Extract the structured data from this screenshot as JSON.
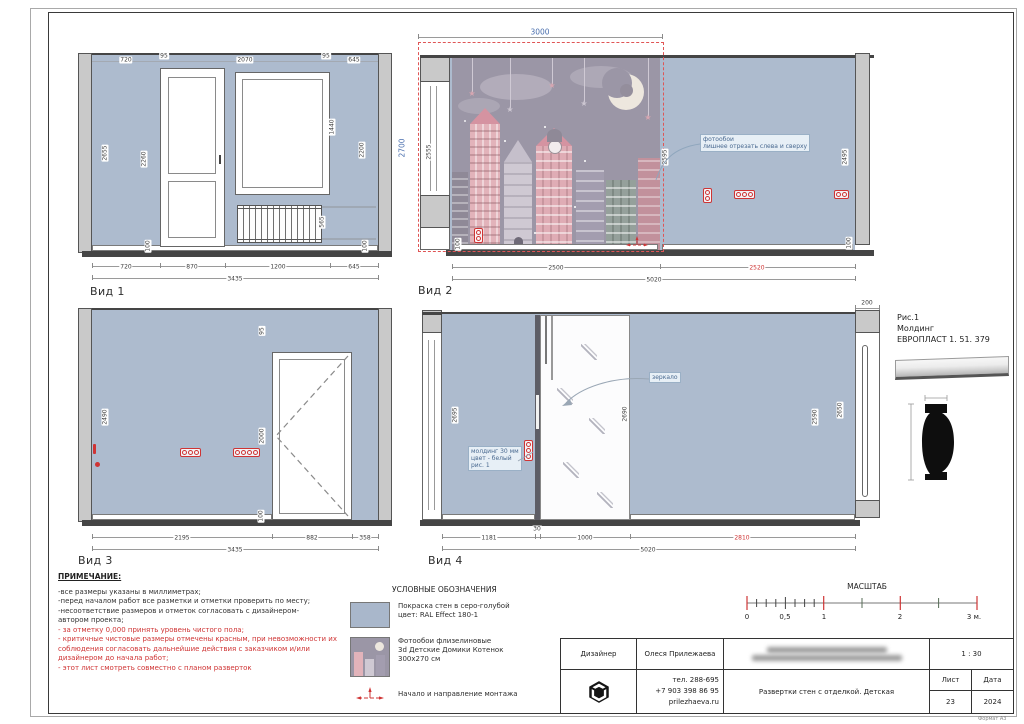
{
  "colors": {
    "wall_blue": "#adbbce",
    "critical_red": "#cf3434",
    "dim_blue": "#4a6fae"
  },
  "v1": {
    "label": "Вид 1",
    "top": [
      "720",
      "95",
      "2070",
      "95",
      "645"
    ],
    "bottom": [
      "720",
      "870",
      "1200",
      "645"
    ],
    "total": "3435",
    "left_h": "2655",
    "door_h": "2260",
    "window_h": "1440",
    "right_h": "2200",
    "radiator_h": "565",
    "base_l": "100",
    "base_r": "100",
    "overall_h": "2700"
  },
  "v2": {
    "label": "Вид 2",
    "top_w": "3000",
    "left_h": "2555",
    "mural_h": "2595",
    "right_h": "2495",
    "base_l": "100",
    "base_r": "100",
    "bottom_l": "2500",
    "bottom_r": "2520",
    "total": "5020",
    "callout1": "фотообои",
    "callout2": "лишнее отрезать слева и сверху"
  },
  "v3": {
    "label": "Вид 3",
    "gap_top": "95",
    "left_h": "2490",
    "door_h": "2000",
    "base": "100",
    "bottom": [
      "2195",
      "882",
      "358"
    ],
    "total": "3435"
  },
  "v4": {
    "label": "Вид 4",
    "top_right": "200",
    "left_h": "2695",
    "mirror_h": "2690",
    "right_h": "2590",
    "return_h": "2650",
    "bottom": [
      "1181",
      "30",
      "1000",
      "2810"
    ],
    "total": "5020",
    "mirror_callout": "зеркало",
    "molding_callout": [
      "молдинг 30 мм",
      "цвет - белый",
      "рис. 1"
    ]
  },
  "fig1": {
    "lines": [
      "Рис.1",
      "Молдинг",
      "ЕВРОПЛАСТ 1. 51. 379"
    ]
  },
  "notes": {
    "title": "ПРИМЕЧАНИЕ:",
    "black": [
      "-все размеры указаны в миллиметрах;",
      "-перед началом работ все разметки и отметки проверить по месту;",
      "-несоответствие размеров и отметок согласовать с дизайнером-",
      "автором проекта;"
    ],
    "red": [
      "- за отметку 0,000 принять уровень чистого пола;",
      "- критичные чистовые размеры отмечены красным, при невозможности их",
      "соблюдения согласовать дальнейшие действия с заказчиком и/или",
      "дизайнером до начала работ;",
      "- этот лист смотреть совместно с планом разверток"
    ]
  },
  "legend": {
    "title": "УСЛОВНЫЕ ОБОЗНАЧЕНИЯ",
    "paint": [
      "Покраска стен в серо-голубой",
      "цвет: RAL Effect 180-1"
    ],
    "wallpaper": [
      "Фотообои флизелиновые",
      "3d Детские Домики Котенок",
      "300х270 см"
    ],
    "mount": "Начало и направление монтажа"
  },
  "scalebar": {
    "title": "МАСШТАБ",
    "labels": [
      "0",
      "0,5",
      "1",
      "2",
      "3 м."
    ]
  },
  "stamp": {
    "designer_label": "Дизайнер",
    "designer_name": "Олеся Прилежаева",
    "scale": "1 : 30",
    "phone1": "тел. 288-695",
    "phone2": "+7 903 398 86 95",
    "site": "prilezhaeva.ru",
    "doc_title": "Развертки стен с отделкой. Детская",
    "sheet_label": "Лист",
    "sheet_no": "23",
    "date_label": "Дата",
    "date_value": "2024"
  },
  "format_label": "Формат А3"
}
